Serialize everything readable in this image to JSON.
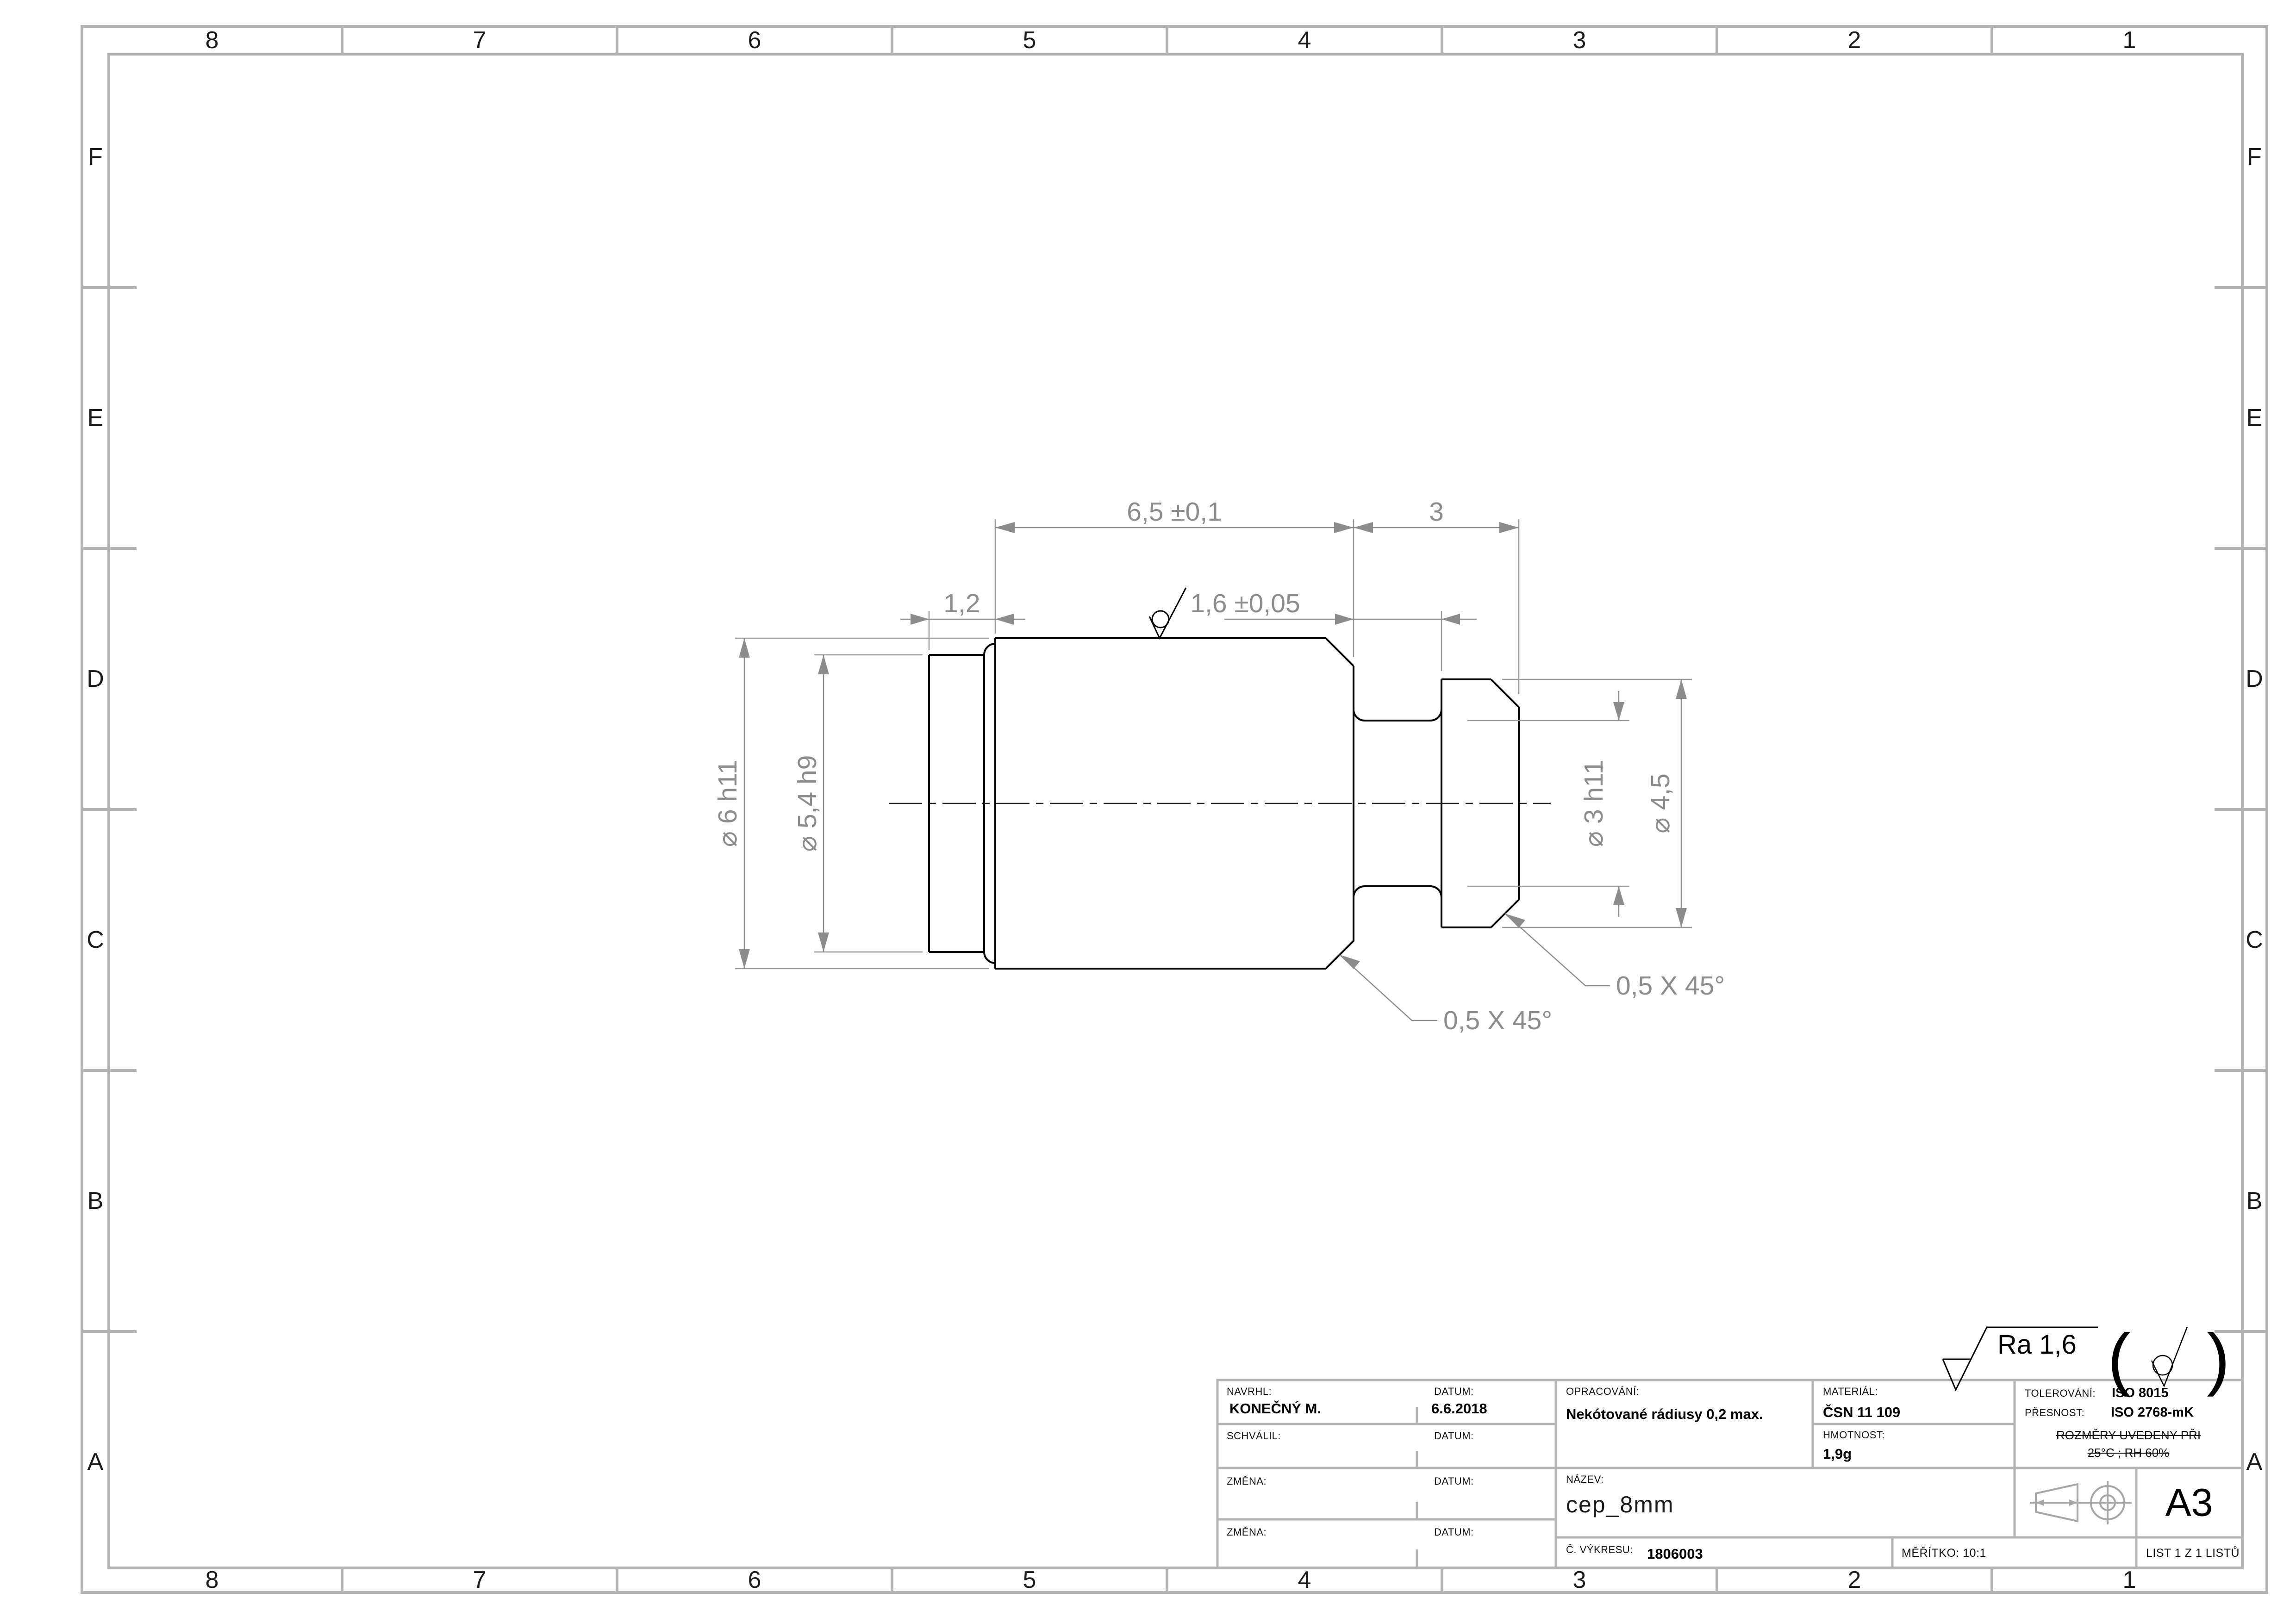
{
  "sheet": {
    "format": "A3"
  },
  "zones": {
    "columns": [
      "8",
      "7",
      "6",
      "5",
      "4",
      "3",
      "2",
      "1"
    ],
    "rows": [
      "F",
      "E",
      "D",
      "C",
      "B",
      "A"
    ]
  },
  "dims": {
    "len_body": "6,5 ±0,1",
    "len_head": "3",
    "len_tenon": "1,2",
    "len_neck": "1,6 ±0,05",
    "dia_body": "⌀ 6 h11",
    "dia_tenon": "⌀ 5,4 h9",
    "dia_neck": "⌀ 3 h11",
    "dia_head": "⌀ 4,5",
    "chamfer": "0,5 X 45°"
  },
  "surface": {
    "ra_note": "Ra  1,6",
    "paren_open": "(",
    "paren_close": ")"
  },
  "titleblock": {
    "navrhl_label": "NAVRHL:",
    "navrhl_value": "KONEČNÝ M.",
    "datum_label": "DATUM:",
    "datum_value": "6.6.2018",
    "schvalil_label": "SCHVÁLIL:",
    "zmena_label": "ZMĚNA:",
    "opracovani_label": "OPRACOVÁNÍ:",
    "opracovani_value": "Nekótované rádiusy 0,2 max.",
    "material_label": "MATERIÁL:",
    "material_value": "ČSN 11 109",
    "hmotnost_label": "HMOTNOST:",
    "hmotnost_value": "1,9g",
    "tolerovani_label": "TOLEROVÁNÍ:",
    "tolerovani_value": "ISO 8015",
    "presnost_label": "PŘESNOST:",
    "presnost_value": "ISO 2768-mK",
    "rozmery_line1": "ROZMĚRY UVEDENY PŘI",
    "rozmery_line2": "25°C ; RH 60%",
    "nazev_label": "NÁZEV:",
    "nazev_value": "cep_8mm",
    "cislo_label": "Č. VÝKRESU:",
    "cislo_value": "1806003",
    "meritko": "MĚŘÍTKO: 10:1",
    "list": "LIST 1 Z 1 LISTŮ",
    "format": "A3"
  }
}
